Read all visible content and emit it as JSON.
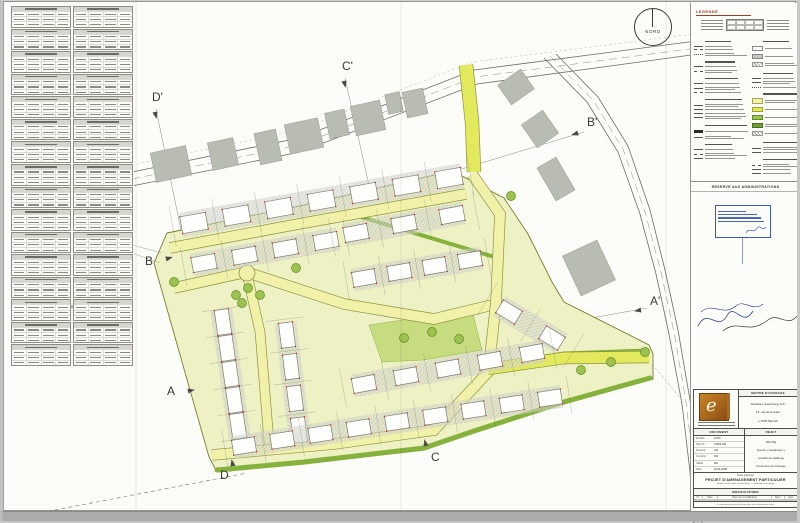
{
  "north_label": "NORD",
  "colors": {
    "site": "#edf1c3",
    "road": "#f1f1aa",
    "bright_road": "#e2e95c",
    "road_casing": "#8f9440",
    "hedge": "#85b23c",
    "green_patch": "#c6dc7e",
    "tree": "#9ec24e",
    "tree_stroke": "#5d8a27",
    "existing_building": "#b9bcb2",
    "house_fill": "#fefefc",
    "house_stroke": "#7e7e76",
    "red_tick": "#c0392b",
    "legend_accent": "#9a3b28",
    "stamp_blue": "#3a5bb5",
    "logo_orange": "#b26a16"
  },
  "left_tables": {
    "columns": 2,
    "tables_per_column": 16,
    "data_rows": 3,
    "data_cols": 4
  },
  "legend": {
    "title": "LEGENDE",
    "admin_header": "RESERVE AUX ADMINISTRATIONS",
    "stamp_bar_widths": [
      92,
      86,
      78,
      55
    ],
    "columns": [
      [
        "hdr",
        "ln",
        "dsh",
        "dot",
        "hdr",
        "ln",
        "dsh",
        "hdr",
        "ln",
        "ln",
        "dsh",
        "hdr",
        "ln",
        "ln",
        "ln",
        "ln",
        "hdr",
        "blk",
        "ln",
        "hdr",
        "ln",
        "dsh",
        "ln"
      ],
      [
        "hdr",
        "wht",
        "gry",
        "hat",
        "hdr",
        "ln",
        "ln",
        "dot",
        "hdr",
        "yel",
        "byl",
        "grn",
        "dgn",
        "hat",
        "hdr",
        "ln",
        "ln",
        "hdr",
        "dsh",
        "ln",
        "ln"
      ]
    ]
  },
  "titleblock": {
    "client_header": "MAITRE D'OUVRAGE",
    "client_lines": [
      "Kikuoka Luxembourg S.A.",
      "16, rue de la Gare",
      "L-7535 Mersch"
    ],
    "doc_header": "DOCUMENT",
    "doc_rows": [
      [
        "Echelle",
        "1/250"
      ],
      [
        "Plan N°",
        "21563-001"
      ],
      [
        "Dessiné",
        "AM"
      ],
      [
        "Contrôlé",
        "SW"
      ],
      [
        "Validé",
        "MG"
      ],
      [
        "Date",
        "20.06.2008"
      ]
    ],
    "object_header": "OBJET",
    "object_lines": [
      "PAP Mg",
      "lieu-dit « Gewannen »",
      "Localité de Hellange",
      "Commune de Frisange"
    ],
    "project_small": "Partie graphique",
    "project_title": "PROJET D'AMENAGEMENT PARTICULIER",
    "project_sub": "portant sur des fonds sis à Hellange — Commune de Frisange",
    "modifications_header": "MODIFICATIONS",
    "mod_cols": [
      "N°",
      "Date",
      "Objet de la modification",
      "Dess.",
      "Appr."
    ],
    "mod_empty_rows": 2,
    "footer": "Ce document ne peut être reproduit sans autorisation écrite"
  },
  "plan": {
    "top_road_edges": [
      "M128,170 L295,136 L470,68 L700,38",
      "M128,184 L296,150 L473,82 L702,51"
    ],
    "top_road_center": "M128,177 L295,143 L471,75 L701,45",
    "top_road_faint": "M128,163 L294,128 L468,60 L698,31",
    "right_road_edges": [
      "M540,56 L583,100 L614,150 L636,212 L652,272 L665,332 L678,402 L686,470 L690,521",
      "M552,52 L594,95 L624,144 L646,208 L661,268 L674,328 L686,398 L694,466 L698,521"
    ],
    "right_road_center": "M546,54 L589,98 L619,147 L641,210 L657,270 L670,330 L682,400 L690,468 L694,521",
    "section_lines": [
      [
        183,
        389,
        643,
        306
      ],
      [
        160,
        257,
        580,
        130
      ],
      [
        424,
        447,
        341,
        76
      ],
      [
        227,
        470,
        152,
        107
      ]
    ],
    "markers": [
      {
        "label": "A",
        "tx": 163,
        "ty": 393,
        "trx": 184,
        "try": 389,
        "rot": -10
      },
      {
        "label": "A'",
        "tx": 646,
        "ty": 303,
        "trx": 637,
        "try": 308,
        "rot": 170
      },
      {
        "label": "B",
        "tx": 141,
        "ty": 263,
        "trx": 162,
        "try": 257,
        "rot": -17
      },
      {
        "label": "B'",
        "tx": 583,
        "ty": 124,
        "trx": 574,
        "try": 131,
        "rot": 163
      },
      {
        "label": "C",
        "tx": 427,
        "ty": 459,
        "trx": 422,
        "try": 444,
        "rot": -103
      },
      {
        "label": "C'",
        "tx": 338,
        "ty": 68,
        "trx": 340,
        "try": 79,
        "rot": 77
      },
      {
        "label": "D",
        "tx": 216,
        "ty": 477,
        "trx": 229,
        "try": 464,
        "rot": -102
      },
      {
        "label": "D'",
        "tx": 148,
        "ty": 99,
        "trx": 151,
        "try": 110,
        "rot": 78
      }
    ],
    "existing_buildings": [
      [
        66,
        288,
        60,
        36,
        -12
      ],
      [
        167,
        162,
        36,
        30,
        -12
      ],
      [
        219,
        152,
        26,
        28,
        -12
      ],
      [
        264,
        145,
        22,
        32,
        -12
      ],
      [
        300,
        134,
        34,
        30,
        -12
      ],
      [
        333,
        122,
        20,
        26,
        -12
      ],
      [
        364,
        116,
        30,
        30,
        -12
      ],
      [
        390,
        101,
        15,
        20,
        -12
      ],
      [
        411,
        101,
        21,
        26,
        -12
      ],
      [
        512,
        85,
        28,
        24,
        -35
      ],
      [
        536,
        127,
        26,
        28,
        -35
      ],
      [
        552,
        177,
        22,
        38,
        -30
      ],
      [
        585,
        266,
        38,
        44,
        -25
      ]
    ],
    "site_polygon": "163,231 300,203 452,168 458,174 500,196 524,232 548,280 560,300 645,343 649,352 649,377 560,402 470,431 420,448 300,462 213,470 205,455 150,261",
    "green_patch": "365,323 468,308 478,348 420,358 378,360",
    "hedges": [
      {
        "d": "M213,468 L300,460 L420,446 L470,429 L560,400 L646,376",
        "w": 5
      },
      {
        "d": "M490,362 L560,351 L644,348",
        "w": 3
      },
      {
        "d": "M357,215 L487,254",
        "w": 4
      }
    ],
    "roads": [
      {
        "d": "M166,246 L300,221 L462,192",
        "w": 10,
        "c": "n"
      },
      {
        "d": "M170,286 L242,270 L340,302 L430,317 L488,303",
        "w": 10,
        "c": "n"
      },
      {
        "d": "M243,272 L256,330 L266,452",
        "w": 9,
        "c": "n"
      },
      {
        "d": "M208,453 L330,442 L430,428 L486,368",
        "w": 10,
        "c": "n"
      },
      {
        "d": "M468,172 L496,212 L492,300 L485,365",
        "w": 10,
        "c": "n"
      },
      {
        "d": "M462,63 L468,120 L470,170",
        "w": 13,
        "c": "b"
      },
      {
        "d": "M484,367 L560,356 L645,355",
        "w": 11,
        "c": "b"
      }
    ],
    "house_rows": [
      [
        190,
        221,
        445,
        176,
        7,
        26,
        17
      ],
      [
        200,
        261,
        322,
        239,
        4,
        24,
        15
      ],
      [
        352,
        231,
        448,
        213,
        3,
        24,
        15
      ],
      [
        360,
        276,
        466,
        258,
        4,
        23,
        15
      ],
      [
        505,
        310,
        548,
        336,
        2,
        22,
        15
      ],
      [
        219,
        320,
        234,
        424,
        5,
        25,
        14
      ],
      [
        283,
        333,
        295,
        428,
        4,
        25,
        14
      ],
      [
        360,
        382,
        528,
        351,
        5,
        23,
        15
      ],
      [
        240,
        444,
        546,
        396,
        9,
        23,
        15
      ]
    ],
    "trees": [
      [
        232,
        293
      ],
      [
        244,
        286
      ],
      [
        256,
        293
      ],
      [
        238,
        301
      ],
      [
        170,
        280
      ],
      [
        292,
        266
      ],
      [
        507,
        194
      ],
      [
        577,
        368
      ],
      [
        607,
        360
      ],
      [
        641,
        350
      ],
      [
        400,
        336
      ],
      [
        428,
        330
      ],
      [
        455,
        337
      ]
    ],
    "leader_lines": [
      [
        128,
        243,
        158,
        251
      ],
      [
        128,
        251,
        156,
        261
      ]
    ],
    "dashed_boundary": "M30,512 L150,489 L243,471",
    "se_connector": "M648,362 L678,398"
  }
}
